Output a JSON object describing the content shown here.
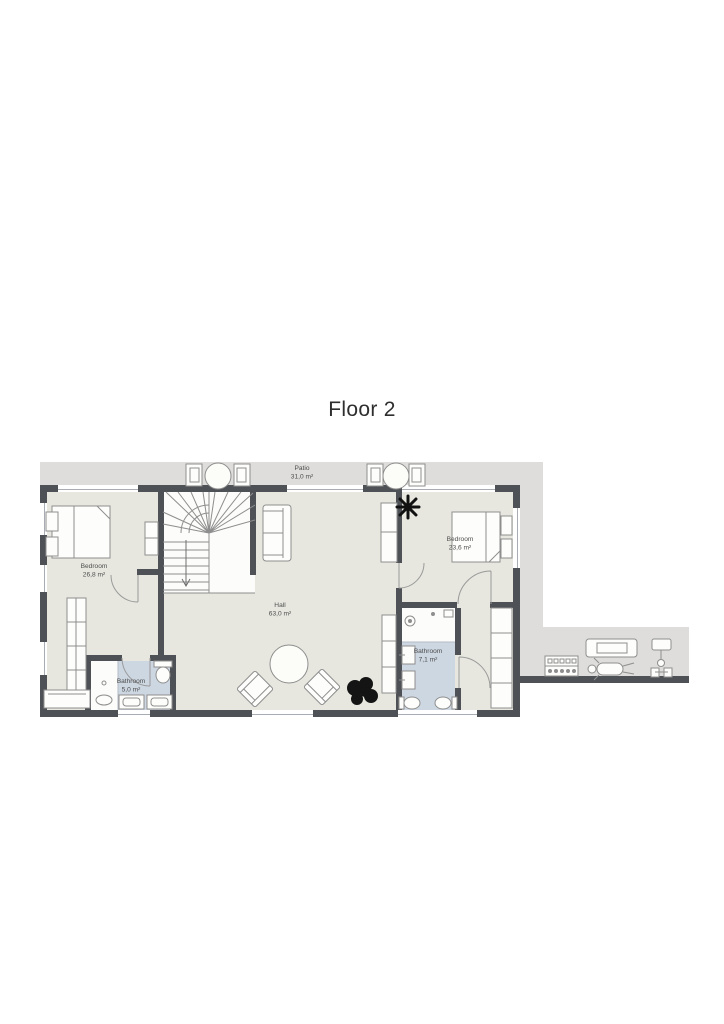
{
  "title": "Floor 2",
  "rooms": {
    "patio": {
      "name": "Patio",
      "area": "31,0 m²"
    },
    "bedroom_left": {
      "name": "Bedroom",
      "area": "26,8 m²"
    },
    "bedroom_right": {
      "name": "Bedroom",
      "area": "23,6 m²"
    },
    "hall": {
      "name": "Hall",
      "area": "63,0 m²"
    },
    "bathroom_left": {
      "name": "Bathroom",
      "area": "5,0 m²"
    },
    "bathroom_right": {
      "name": "Bathroom",
      "area": "7,1 m²"
    }
  },
  "colors": {
    "wall": "#4e5156",
    "floor": "#e7e7df",
    "patio_floor": "#dedddb",
    "bathroom_floor": "#cdd7e2",
    "furniture_stroke": "#8e8e8e",
    "plant": "#141414"
  },
  "furniture": [
    "staircase",
    "double-bed",
    "nightstand",
    "wardrobe",
    "sofa",
    "cabinet",
    "desk",
    "round-table",
    "armchair",
    "plant",
    "toilet",
    "sink",
    "shower",
    "closet",
    "patio-table",
    "patio-chair",
    "dumbbell-rack",
    "treadmill",
    "weight-bench",
    "exercise-bike"
  ]
}
